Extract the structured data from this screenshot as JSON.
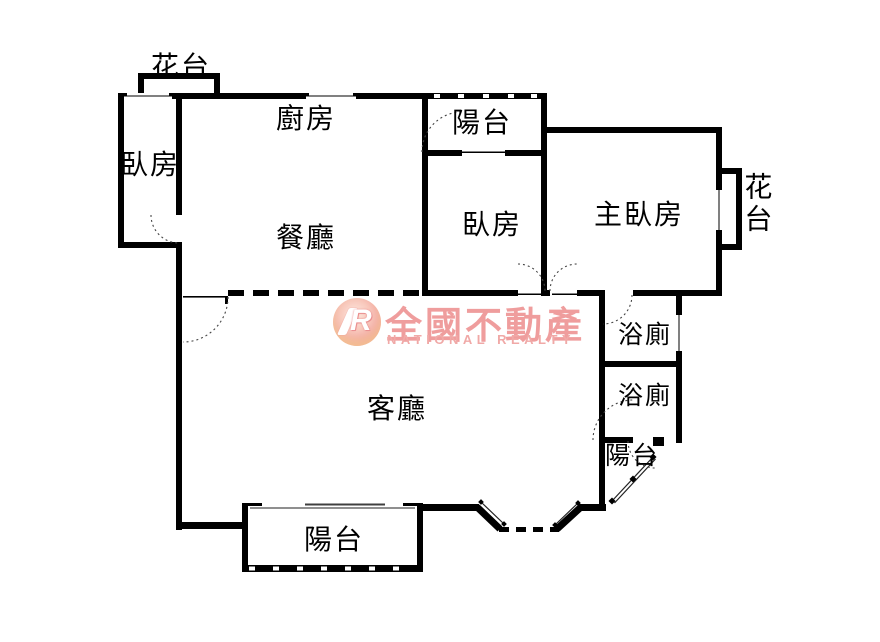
{
  "floorplan": {
    "rooms": {
      "flower_top_left": "花台",
      "bedroom_left": "臥房",
      "kitchen": "廚房",
      "dining": "餐廳",
      "balcony_top": "陽台",
      "bedroom_middle": "臥房",
      "master_bedroom": "主臥房",
      "flower_right": "花台",
      "bathroom_1": "浴廁",
      "bathroom_2": "浴廁",
      "balcony_right": "陽台",
      "living_room": "客廳",
      "balcony_bottom": "陽台"
    },
    "watermark": {
      "logo_letter": "R",
      "brand": "全國不動產",
      "brand_en": "NATIONAL REALTY",
      "brand_color": "#ef9a9a",
      "badge_color": "#ec8a8c"
    },
    "colors": {
      "wall": "#000000",
      "background": "#ffffff"
    }
  }
}
